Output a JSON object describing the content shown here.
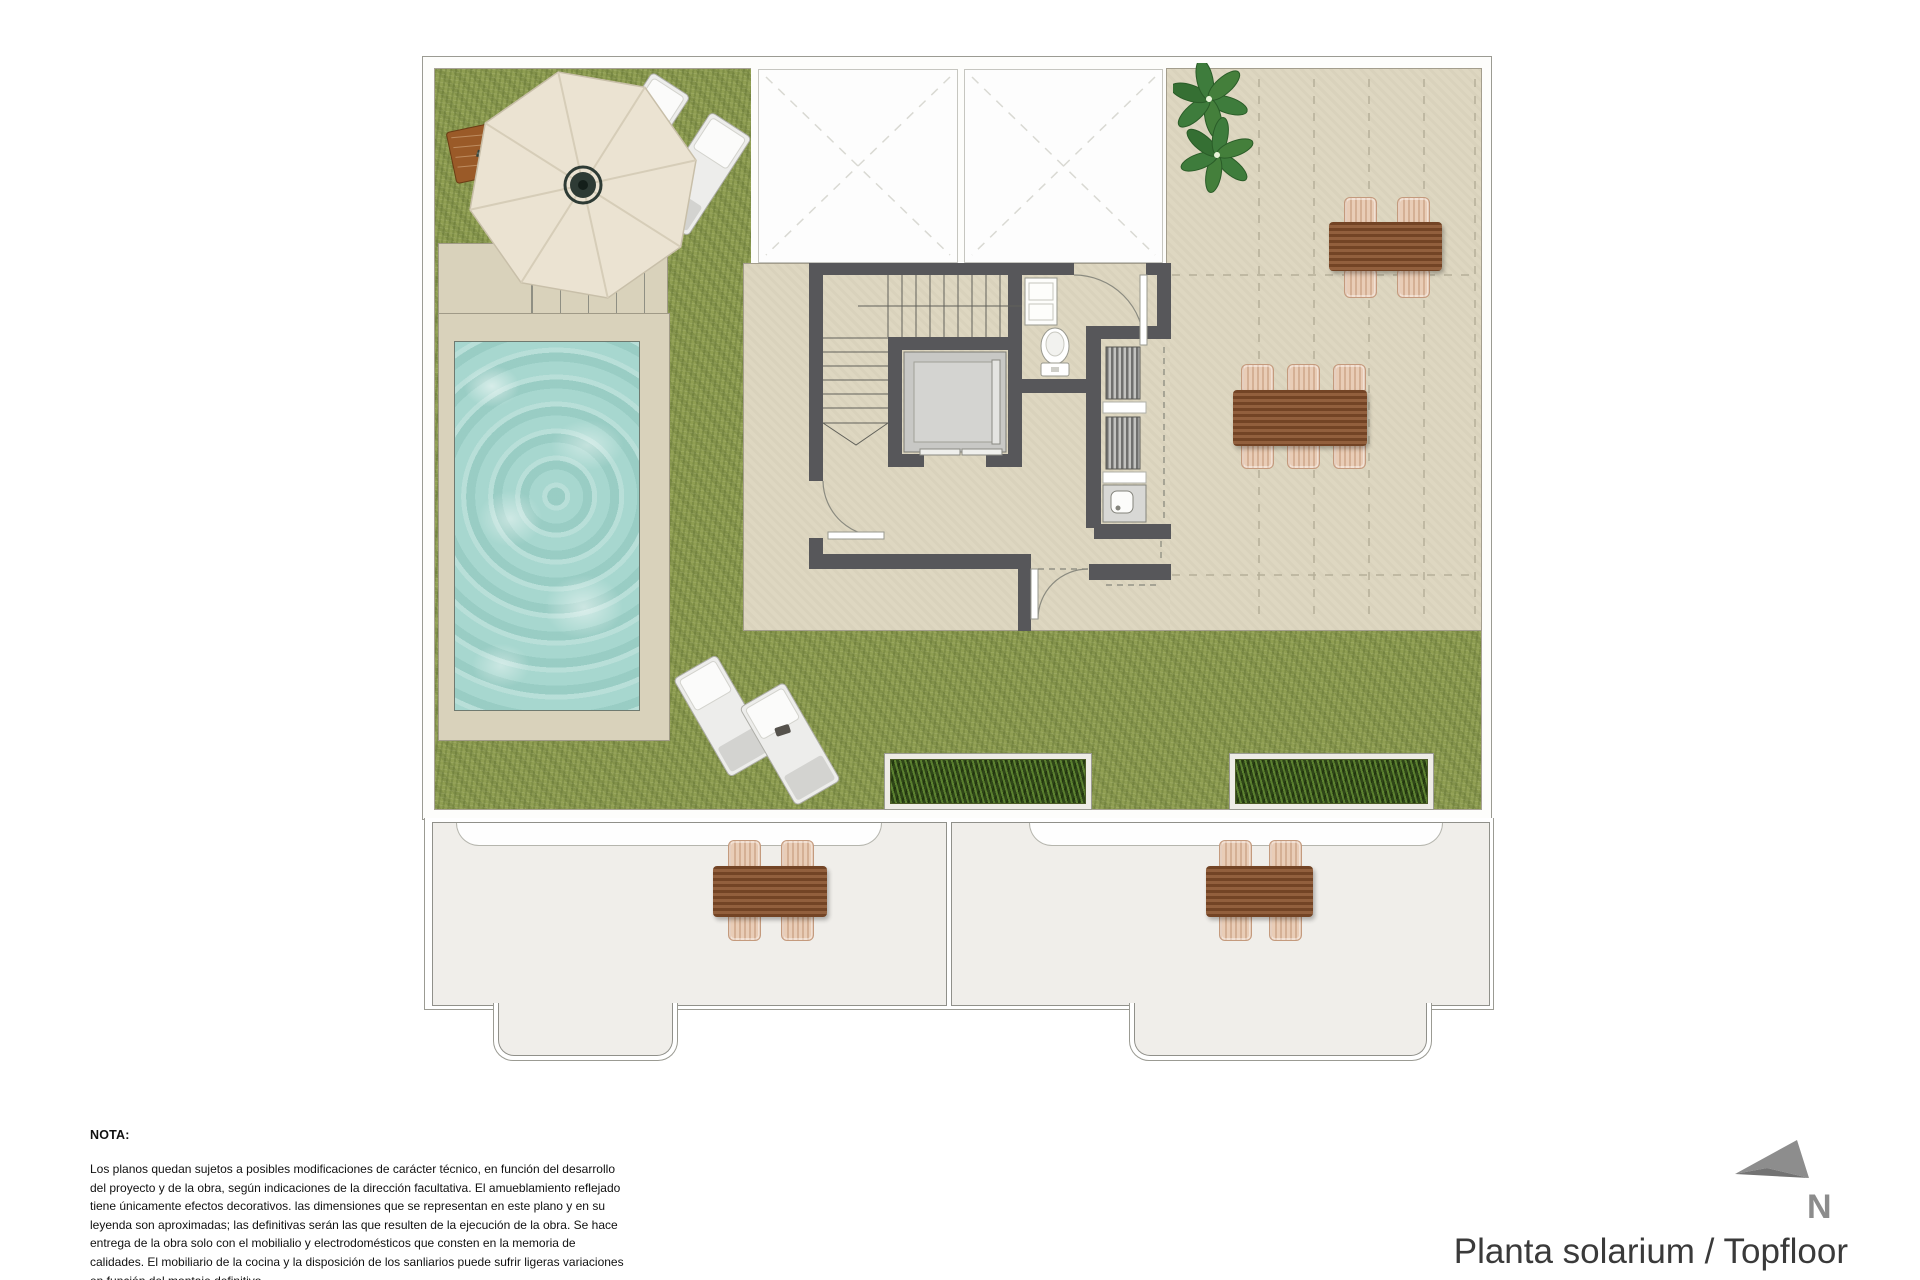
{
  "title": "Planta solarium / Topfloor",
  "compass": {
    "label": "N"
  },
  "note": {
    "heading": "NOTA:",
    "body": "Los planos quedan sujetos a posibles modificaciones de carácter técnico, en función del desarrollo del proyecto y de la obra, según indicaciones de la dirección facultativa. El amueblamiento reflejado tiene únicamente efectos decorativos. las dimensiones que se representan en este plano y en su leyenda son aproximadas; las definitivas serán las que resulten de la ejecución de la obra. Se hace entrega de la obra solo con el mobilialio y electrodomésticos que consten en la memoria de calidades. El mobiliario de la cocina y la disposición de los sanliarios puede sufrir ligeras variaciones en función del montaje definitivo."
  },
  "plan": {
    "icons": {
      "north_arrow": "north-arrow",
      "parasol": "parasol-top-view",
      "sun_lounger": "sun-lounger-top-view",
      "dining_table": "wood-dining-table-top-view",
      "chair": "rattan-chair-top-view",
      "plant": "potted-plant-top-view",
      "toilet": "toilet-top-view",
      "washbasin_cabinet": "washbasin-cabinet-top-view",
      "elevator": "elevator-car-top-view",
      "stairs": "staircase-top-view",
      "louver_unit": "louvered-equipment-unit",
      "sink": "sink-top-view",
      "planter": "grass-planter-box",
      "pool": "swimming-pool-water",
      "skylight": "skylight-void-cross"
    },
    "counts": {
      "skylight_voids": 2,
      "sun_loungers": 4,
      "planter_boxes": 2,
      "dining_sets_top": 2,
      "dining_sets_lower": 2
    }
  },
  "colors": {
    "grass": "#8f9e52",
    "terrace": "#ded7c1",
    "pool_water": "#a7d7cf",
    "pool_deck": "#d9d2bb",
    "wall": "#57575a",
    "wood_table": "#8a5430",
    "chair_rattan": "#e9cdb7",
    "leaf_green": "#3e7c3c",
    "lower_floor": "#f0eeea",
    "compass_gray": "#8c8c8c",
    "title_text": "#3a3a3a"
  }
}
